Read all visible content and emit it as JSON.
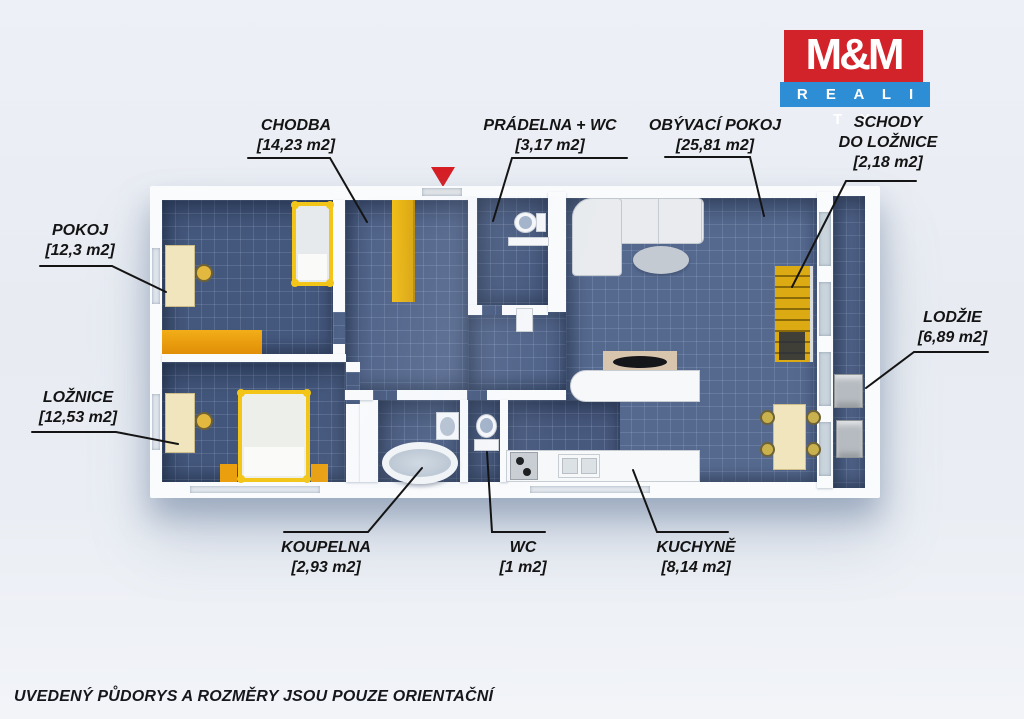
{
  "logo": {
    "mm": "M&M",
    "reality": "R E A L I T Y"
  },
  "disclaimer": "UVEDENÝ PŮDORYS A ROZMĚRY JSOU POUZE ORIENTAČNÍ",
  "rooms": [
    {
      "id": "chodba",
      "name": "CHODBA",
      "area": "[14,23 m2]"
    },
    {
      "id": "pradelna",
      "name": "PRÁDELNA + WC",
      "area": "[3,17 m2]"
    },
    {
      "id": "obyvaci",
      "name": "OBÝVACÍ POKOJ",
      "area": "[25,81 m2]"
    },
    {
      "id": "schody",
      "name": "SCHODY",
      "name2": "DO LOŽNICE",
      "area": "[2,18 m2]"
    },
    {
      "id": "pokoj",
      "name": "POKOJ",
      "area": "[12,3 m2]"
    },
    {
      "id": "loznice",
      "name": "LOŽNICE",
      "area": "[12,53 m2]"
    },
    {
      "id": "lodzie",
      "name": "LODŽIE",
      "area": "[6,89 m2]"
    },
    {
      "id": "koupelna",
      "name": "KOUPELNA",
      "area": "[2,93 m2]"
    },
    {
      "id": "wc",
      "name": "WC",
      "area": "[1 m2]"
    },
    {
      "id": "kuchyne",
      "name": "KUCHYNĚ",
      "area": "[8,14 m2]"
    }
  ],
  "colors": {
    "brand_red": "#d2232a",
    "brand_blue": "#2e8ed5",
    "marker_red": "#d81f26",
    "floor_blue": "#46597e",
    "furn_yellow": "#eab308",
    "furn_orange": "#ec9d09",
    "wood_cream": "#f1e5bd",
    "label": "#141414"
  }
}
